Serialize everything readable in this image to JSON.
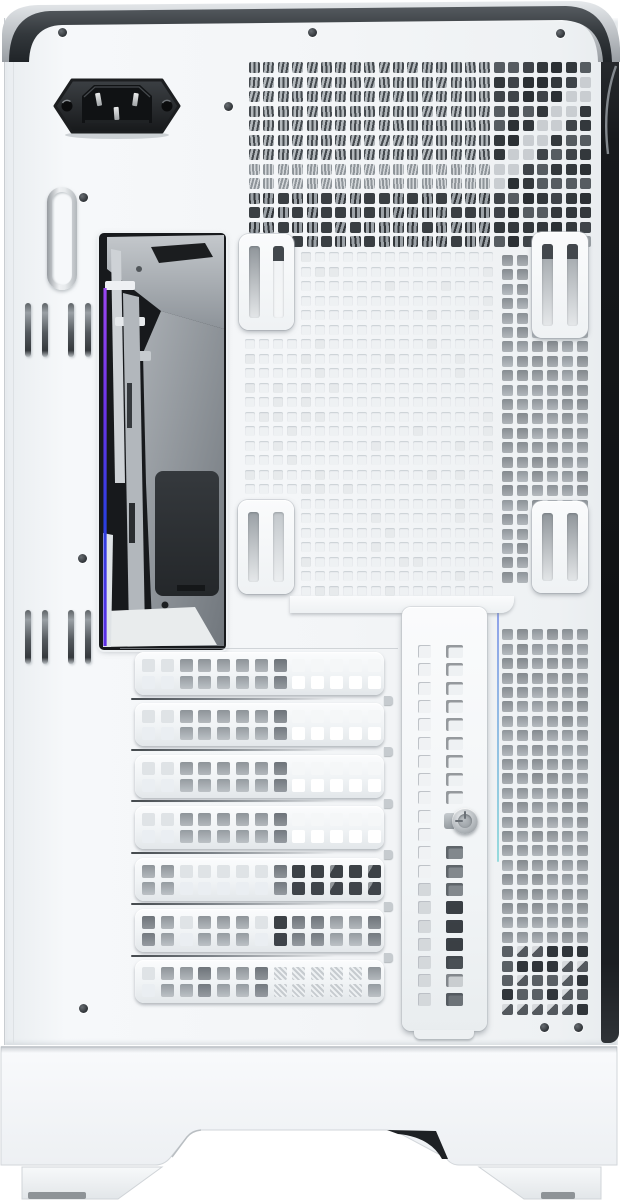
{
  "meta": {
    "subject": "white-pc-case-rear-panel-photo",
    "visible_text": "none"
  },
  "palette": {
    "background": "#ffffff",
    "panel": "#f4f6f8",
    "band_dark": "#33383c",
    "band_silver": "#c9cdd1",
    "side_strip_black": "#17191c",
    "hole_white": "#eef1f3",
    "hole_grey": "#a3a9ae",
    "hole_dark": "#383d41",
    "stripe_light": "#b4b9bd",
    "rgb_purple": "#8a3cf0",
    "rgb_blue": "#2a3fe0",
    "foot_pad": "#8e9397",
    "pci_letters": {
      "W": "#f5f7f8",
      "L": "#dfe3e6",
      "G": "#a6acb1",
      "D": "#7b8187",
      "K": "#3c4146",
      "H": "hatch"
    }
  },
  "parts": {
    "ac_inlet": "c14-power-inlet",
    "top_vent": "rear-exhaust-vent-grid",
    "io_window": "motherboard-io-cutout-window",
    "pci_slots_label": "expansion-slot-covers",
    "bracket": "vertical-gpu-bracket-cover",
    "feet": "case-feet"
  },
  "screws": [
    [
      62,
      32
    ],
    [
      312,
      32
    ],
    [
      560,
      33
    ],
    [
      228,
      106
    ],
    [
      83,
      197
    ],
    [
      82,
      558
    ],
    [
      83,
      1008
    ],
    [
      544,
      1027
    ],
    [
      578,
      1027
    ]
  ],
  "tie_slot_pairs": [
    [
      25,
      303
    ],
    [
      68,
      303
    ],
    [
      25,
      610
    ],
    [
      68,
      610
    ]
  ],
  "vent_grid": {
    "x": 249,
    "y": 62,
    "cols": 24,
    "rows": 13,
    "pitch_x": 14.4,
    "pitch_y": 14.5,
    "hole": 11
  },
  "center_grid": {
    "x": 245,
    "y": 252,
    "cols": 18,
    "rows": 24,
    "pitch_x": 14.0,
    "pitch_y": 14.5,
    "hole": 10,
    "skip_rects": [
      [
        237,
        231,
        60,
        101
      ],
      [
        235,
        498,
        62,
        98
      ]
    ]
  },
  "right_grid": {
    "x": 502,
    "y": 255,
    "cols": 6,
    "pitch_x": 15.0,
    "pitch_y": 14.4,
    "hole": 11,
    "y_end": 1004,
    "skip_band": [
      586,
      624
    ],
    "dark_from_y": 938
  },
  "pci": {
    "count": 7,
    "x": 135,
    "first_y": 652,
    "pitch": 51.4,
    "width": 249,
    "height": 43,
    "hole": 13,
    "hole_pitch": 18.8,
    "rows_y": [
      7,
      24
    ],
    "schemes": [
      "LLGGGGGDWWWWW",
      "LLGGGGGDWWWWW",
      "LLGGGGGDWWWWW",
      "LLGGGGGDWWWWW",
      "GGLLLLLDKKKKK",
      "DGLGGGLKDDGGD",
      "LGGDGGDHHHHHG"
    ]
  },
  "bracket_holes": {
    "first_y": 645,
    "pitch": 18.3,
    "rows": 20,
    "colA_x": 418,
    "colB_x": 446,
    "screw_skip_rows": [
      9,
      10
    ],
    "dark_from_row": 11
  },
  "plates": [
    {
      "x": 239,
      "y": 234,
      "w": 55,
      "h": 96,
      "slots": [
        {
          "c": "#8f959a",
          "cap": false
        },
        {
          "c": "#f0f2f4",
          "cap": true
        }
      ]
    },
    {
      "x": 532,
      "y": 232,
      "w": 56,
      "h": 106,
      "slots": [
        {
          "c": "#9aa0a5",
          "cap": true
        },
        {
          "c": "#9aa0a5",
          "cap": true
        }
      ]
    },
    {
      "x": 238,
      "y": 500,
      "w": 56,
      "h": 94,
      "slots": [
        {
          "c": "#9aa0a5",
          "cap": false
        },
        {
          "c": "#c2c7cb",
          "cap": false
        }
      ]
    },
    {
      "x": 532,
      "y": 501,
      "w": 56,
      "h": 92,
      "slots": [
        {
          "c": "#8f959a",
          "cap": false
        },
        {
          "c": "#8f959a",
          "cap": false
        }
      ]
    }
  ]
}
